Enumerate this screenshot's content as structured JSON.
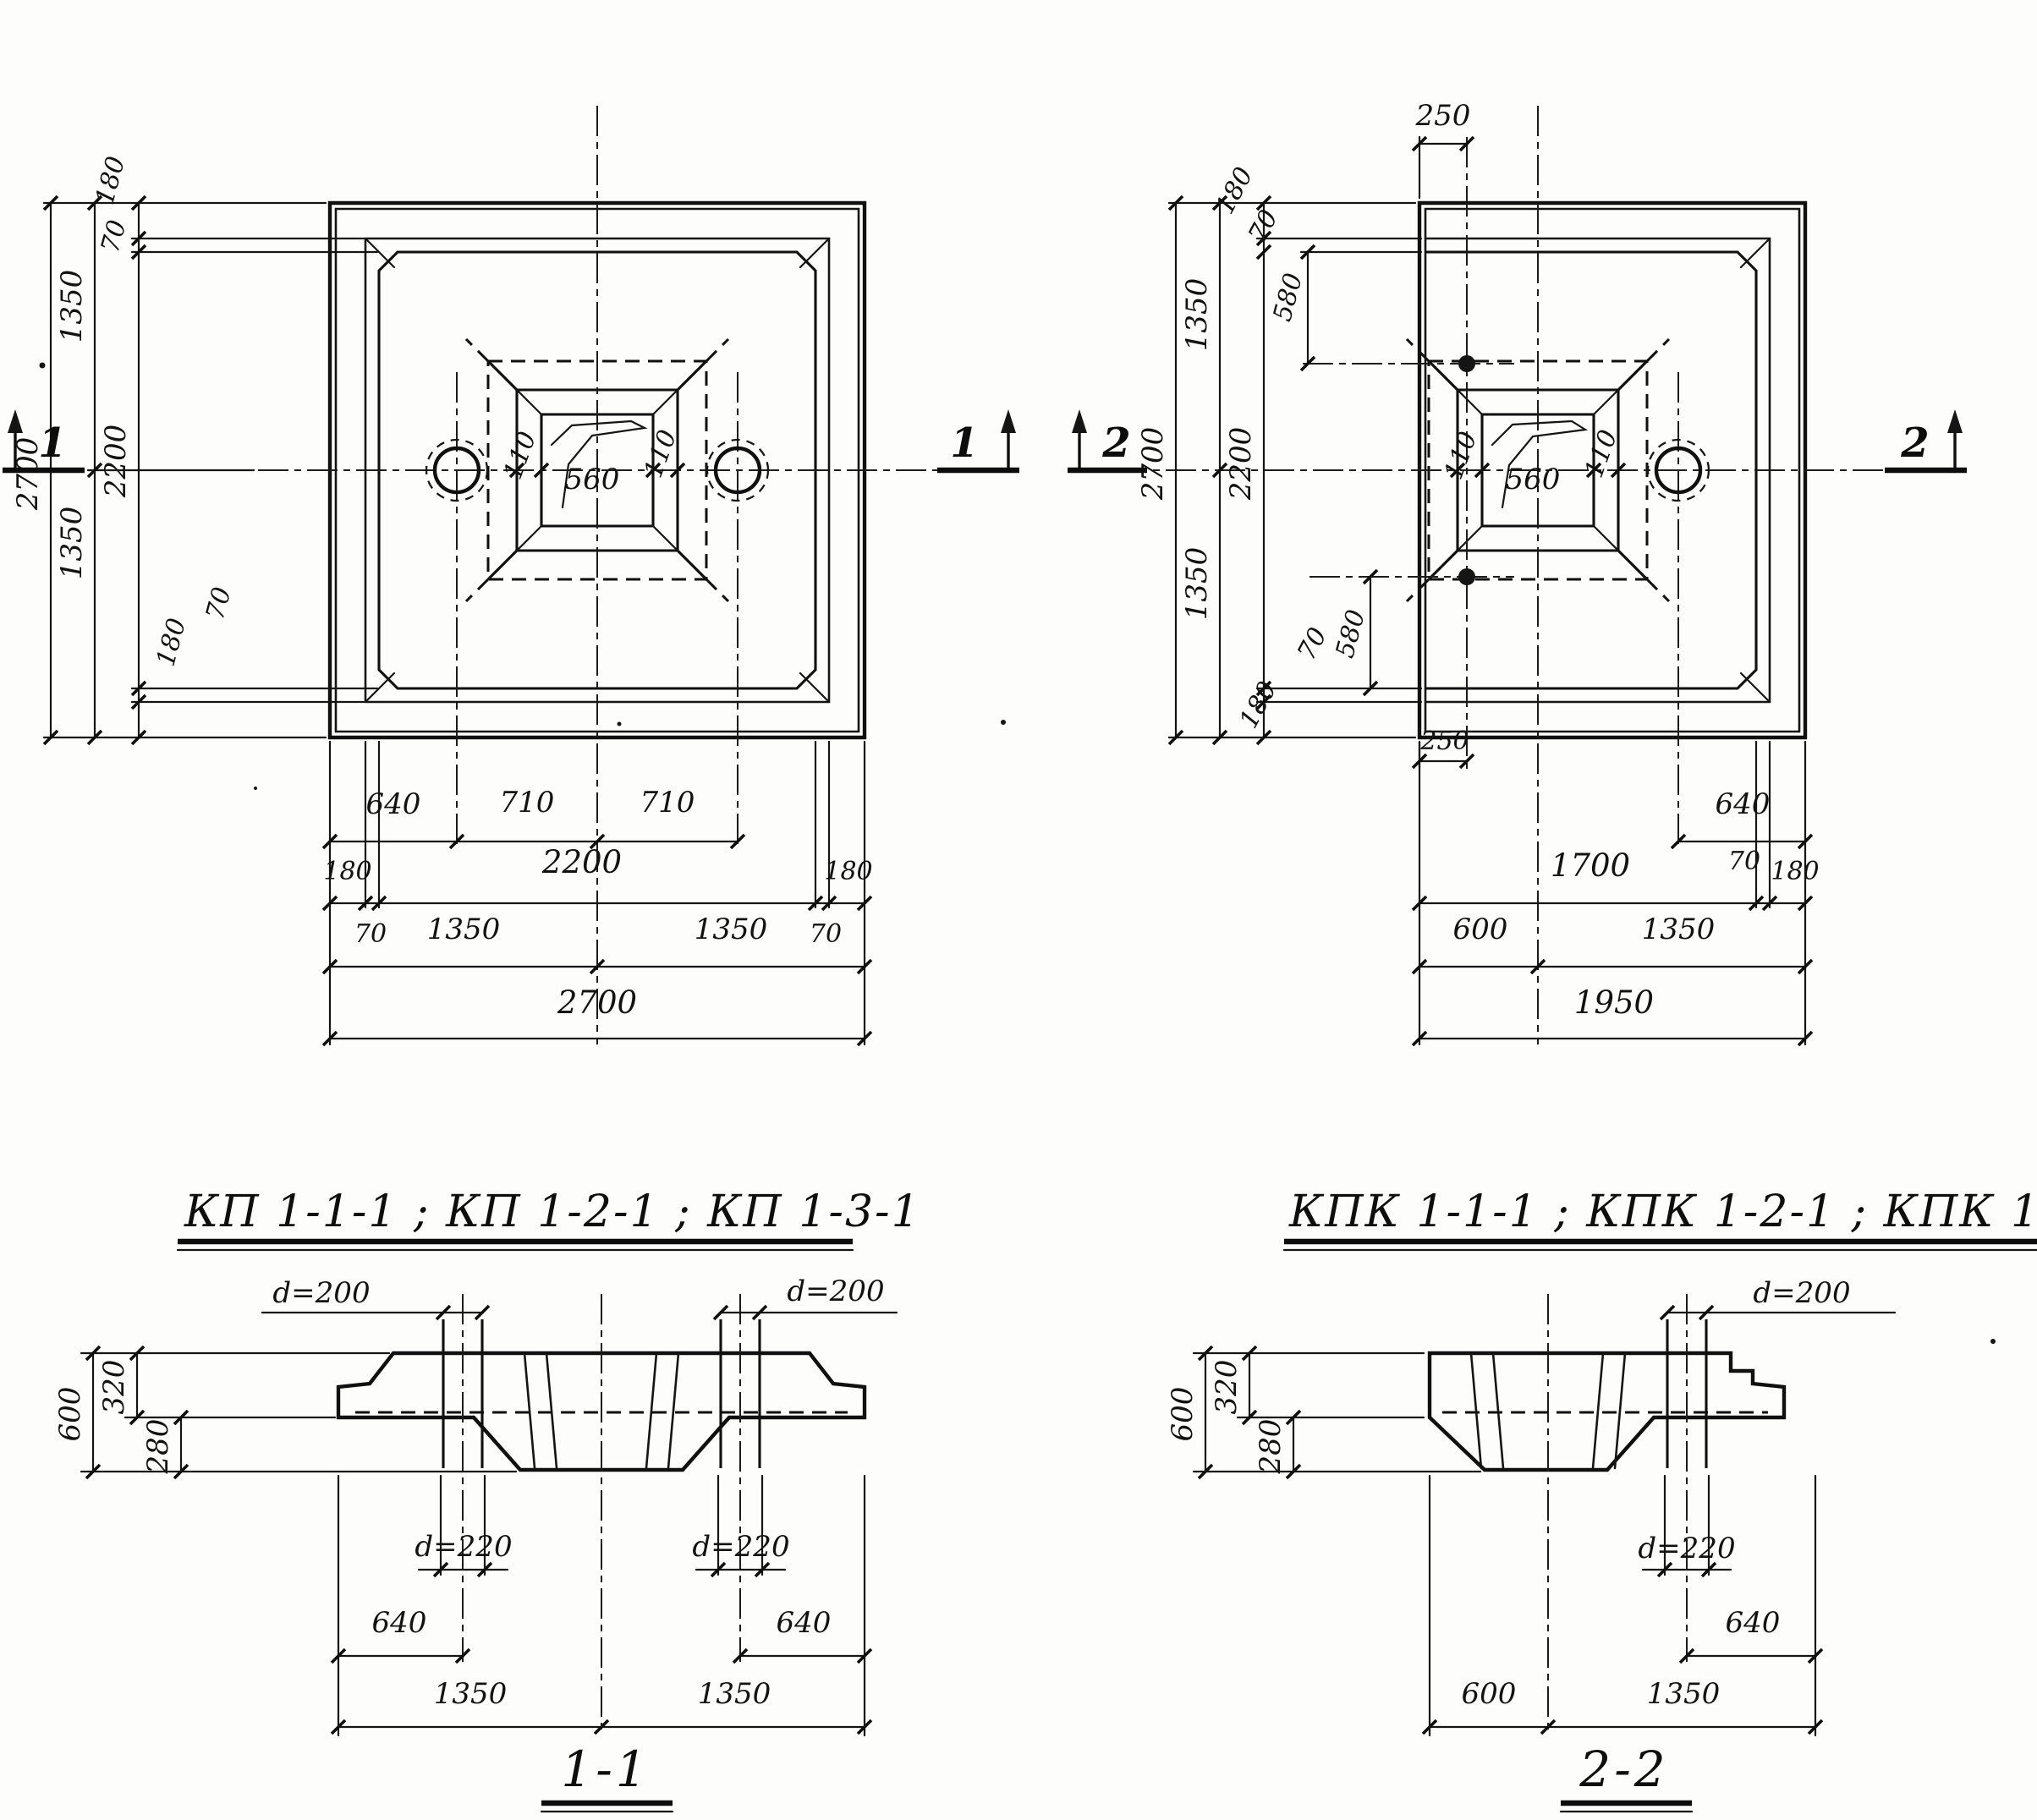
{
  "titles": {
    "kp": "КП 1-1-1 ; КП 1-2-1 ; КП 1-3-1",
    "kpk": "КПК 1-1-1 ; КПК 1-2-1 ; КПК 1-3-1",
    "s11": "1-1",
    "s22": "2-2"
  },
  "markers": {
    "m1": "1",
    "m2": "2"
  },
  "plan_kp": {
    "v2700": "2700",
    "v1350t": "1350",
    "v1350b": "1350",
    "v2200": "2200",
    "v180t": "180",
    "v70t": "70",
    "v70b": "70",
    "v180b": "180",
    "h640": "640",
    "h710a": "710",
    "h710b": "710",
    "h180l": "180",
    "h2200": "2200",
    "h180r": "180",
    "h70l": "70",
    "h1350l": "1350",
    "h1350r": "1350",
    "h70r": "70",
    "h2700": "2700",
    "opening": "560",
    "wall_l": "110",
    "wall_r": "110"
  },
  "plan_kpk": {
    "top250": "250",
    "bot250": "250",
    "v2700": "2700",
    "v1350t": "1350",
    "v1350b": "1350",
    "v2200": "2200",
    "v180t": "180",
    "v70t": "70",
    "v580t": "580",
    "v580b": "580",
    "v70b": "70",
    "v180b": "180",
    "h640": "640",
    "h1700": "1700",
    "h70": "70",
    "h180": "180",
    "h600": "600",
    "h1350": "1350",
    "h1950": "1950",
    "opening": "560",
    "wall_l": "110",
    "wall_r": "110"
  },
  "sec11": {
    "dl": "d=200",
    "dr": "d=200",
    "hl": "d=220",
    "hr": "d=220",
    "v600": "600",
    "v320": "320",
    "v280": "280",
    "o640l": "640",
    "o640r": "640",
    "h1350l": "1350",
    "h1350r": "1350"
  },
  "sec22": {
    "d": "d=200",
    "h": "d=220",
    "v600": "600",
    "v320": "320",
    "v280": "280",
    "o640": "640",
    "h600": "600",
    "h1350": "1350"
  }
}
